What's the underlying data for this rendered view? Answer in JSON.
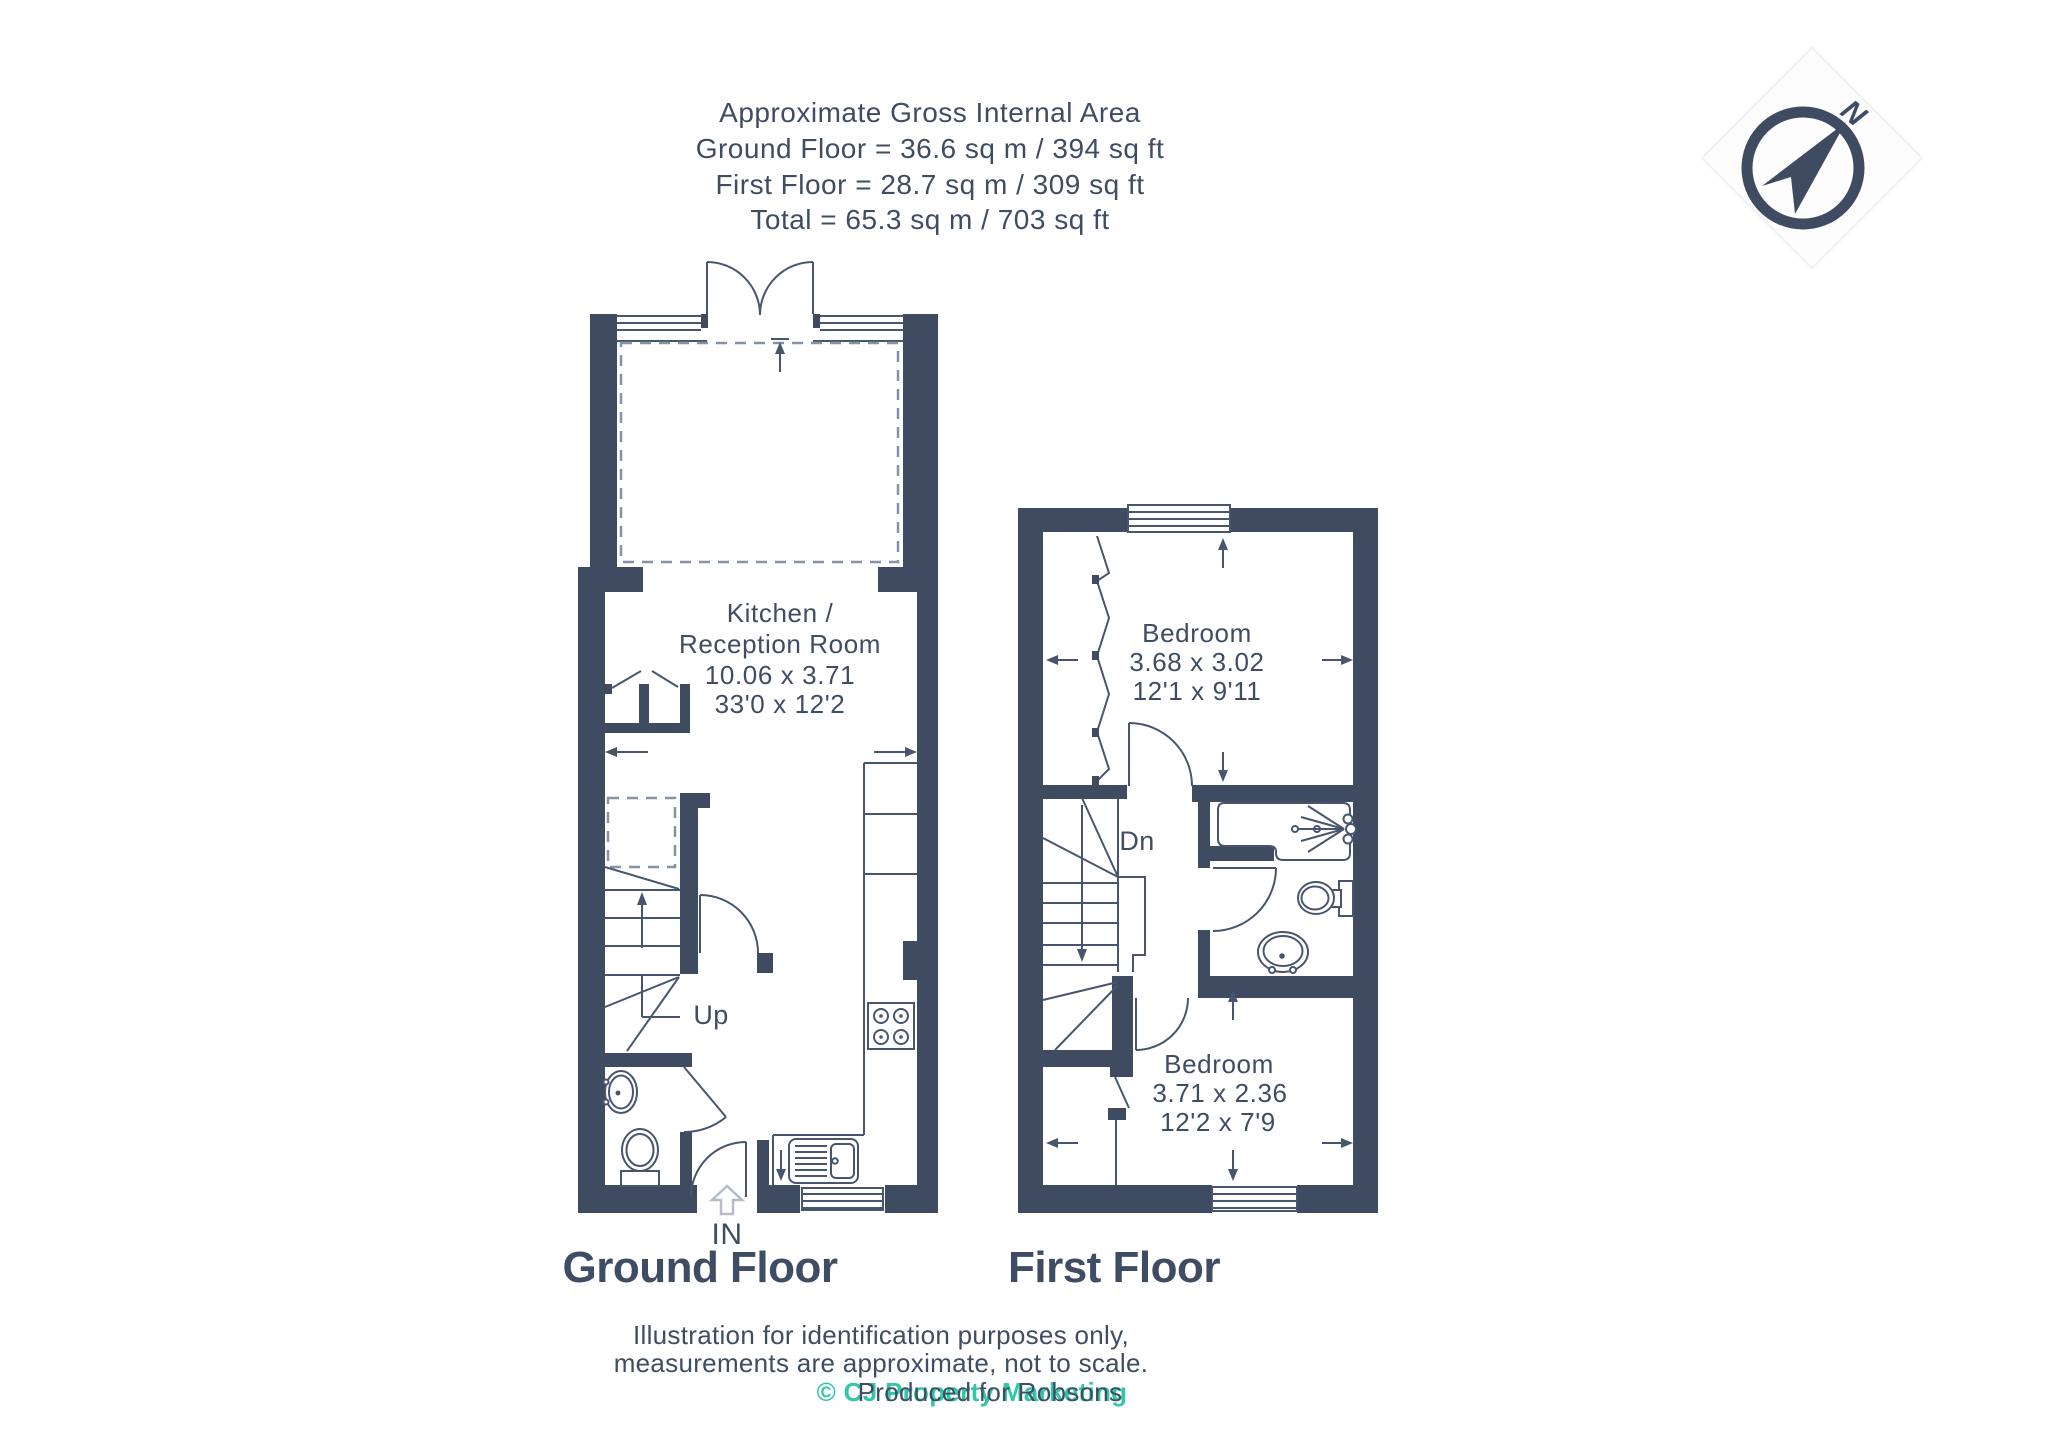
{
  "header": {
    "line1": "Approximate Gross Internal Area",
    "line2": "Ground Floor = 36.6 sq m / 394 sq ft",
    "line3": "First Floor = 28.7 sq m / 309 sq ft",
    "line4": "Total = 65.3 sq m / 703 sq ft"
  },
  "compass": {
    "north_label": "N"
  },
  "ground_floor": {
    "title": "Ground Floor",
    "room": {
      "name_line1": "Kitchen /",
      "name_line2": "Reception Room",
      "dims_metric": "10.06 x 3.71",
      "dims_imperial": "33'0 x 12'2"
    },
    "stairs_label": "Up",
    "entrance_label": "IN"
  },
  "first_floor": {
    "title": "First Floor",
    "bedroom1": {
      "name": "Bedroom",
      "dims_metric": "3.68 x 3.02",
      "dims_imperial": "12'1 x 9'11"
    },
    "bedroom2": {
      "name": "Bedroom",
      "dims_metric": "3.71 x 2.36",
      "dims_imperial": "12'2 x 7'9"
    },
    "stairs_label": "Dn"
  },
  "footer": {
    "line1": "Illustration for identification purposes only,",
    "line2": "measurements are approximate, not to scale.",
    "credit": "© CJ Property Marketing",
    "produced": "Produced for Robsons"
  },
  "colors": {
    "wall": "#3e4b61",
    "text": "#3e4d64",
    "accent_teal": "#2fc7a6",
    "dashed_gray": "#8693a5"
  }
}
